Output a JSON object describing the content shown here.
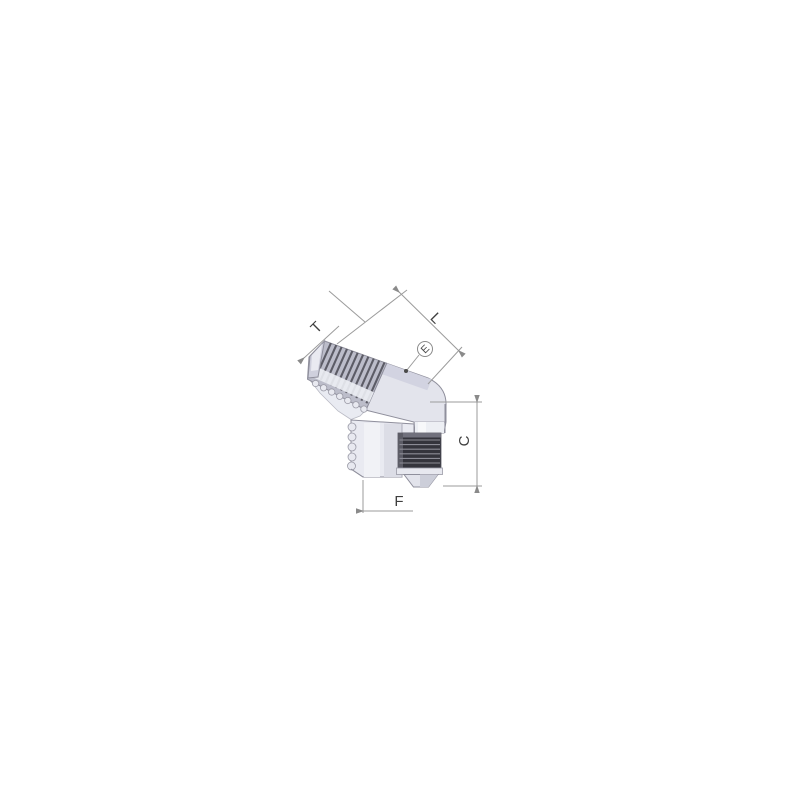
{
  "diagram": {
    "description": "Dimensioned catalog drawing of a 45-degree male elbow hydraulic tube fitting (male pipe thread upper arm, male JIC flare lower port)",
    "labels": {
      "T": "T",
      "L": "L",
      "E": "E",
      "C": "C",
      "F": "F"
    },
    "colors": {
      "background": "#ffffff",
      "line": "#9b9b9b",
      "label_text": "#3f3f3f",
      "metal_light": "#f1f2f6",
      "metal_mid": "#e3e4ec",
      "metal_top_face": "#d2d3e1",
      "metal_shadow": "#ccced9",
      "npt_thread_zone": "#bcbdca",
      "npt_ridge": "#52525c",
      "jic_thread_dark": "#34343c",
      "jic_ridge": "#8b8b95",
      "edge": "#8f8f9c"
    }
  }
}
